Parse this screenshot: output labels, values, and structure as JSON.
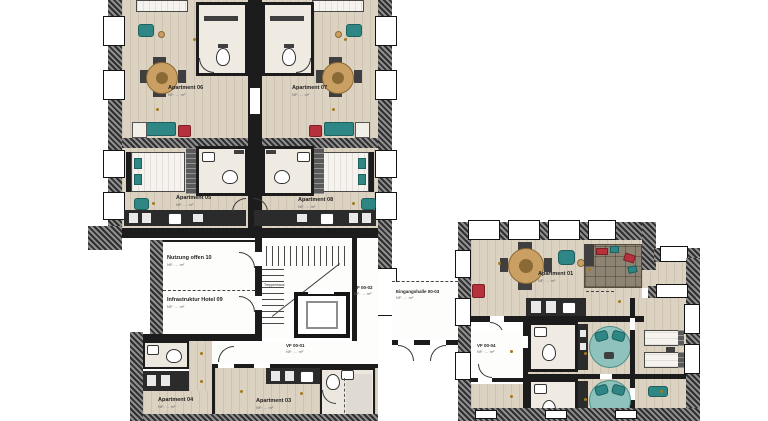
{
  "plan": {
    "title": "Ground floor plan — hotel / apartments",
    "labels": {
      "apartment_06": {
        "name": "Apartment 06",
        "area": "NF: … m²"
      },
      "apartment_07": {
        "name": "Apartment 07",
        "area": "NF: … m²"
      },
      "apartment_05": {
        "name": "Apartment 05",
        "area": "NF: … m²"
      },
      "apartment_08": {
        "name": "Apartment 08",
        "area": "NF: … m²"
      },
      "nutzung_offen_10": {
        "name": "Nutzung offen 10",
        "area": "NF: … m²"
      },
      "infrastruktur_hotel_09": {
        "name": "Infrastruktur Hotel 09",
        "area": "NF: … m²"
      },
      "treppenhaus": {
        "name": "Treppenhaus"
      },
      "vf_00_02": {
        "name": "VF 00-02",
        "area": "NF: … m²"
      },
      "eingangshalle_00_03": {
        "name": "Eingangshalle 00-03",
        "area": "NF: … m²"
      },
      "vf_00_01": {
        "name": "VF 00-01",
        "area": "NF: … m²"
      },
      "apartment_04": {
        "name": "Apartment 04",
        "area": "NF: … m²"
      },
      "apartment_03": {
        "name": "Apartment 03",
        "area": "NF: … m²"
      },
      "apartment_01": {
        "name": "Apartment 01",
        "area": "NF: … m²"
      },
      "vf_00_04": {
        "name": "VF 00-04",
        "area": "NF: … m²"
      }
    },
    "colors": {
      "wall": "#1c1c1c",
      "wood_floor": "#dcd2c1",
      "bath_floor": "#efeae2",
      "teal_furniture": "#2e8784",
      "red_furniture": "#b5323c",
      "table_wood": "#c99f63",
      "round_bed": "#8fc2bc",
      "counter": "#2b2b2b",
      "lamp_dot": "#a5791c"
    }
  }
}
